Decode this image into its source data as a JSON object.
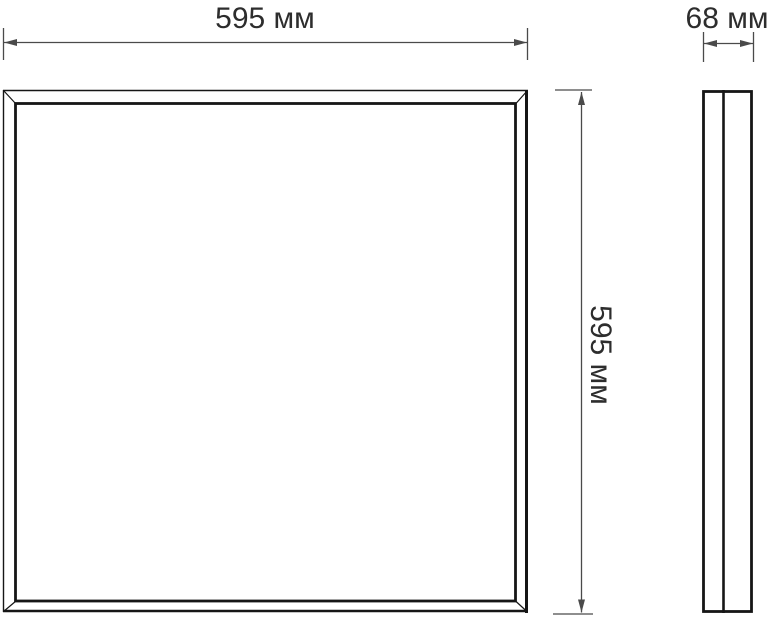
{
  "diagram": {
    "type": "technical-dimension-drawing",
    "views": [
      "front",
      "side"
    ],
    "labels": {
      "width": "595 мм",
      "height": "595 мм",
      "depth": "68 мм"
    },
    "dimensions_mm": {
      "width": 595,
      "height": 595,
      "depth": 68
    },
    "colors": {
      "background": "#ffffff",
      "drawing_line": "#161616",
      "dimension_line": "#4a4a4a",
      "text": "#2d2d2d"
    }
  }
}
